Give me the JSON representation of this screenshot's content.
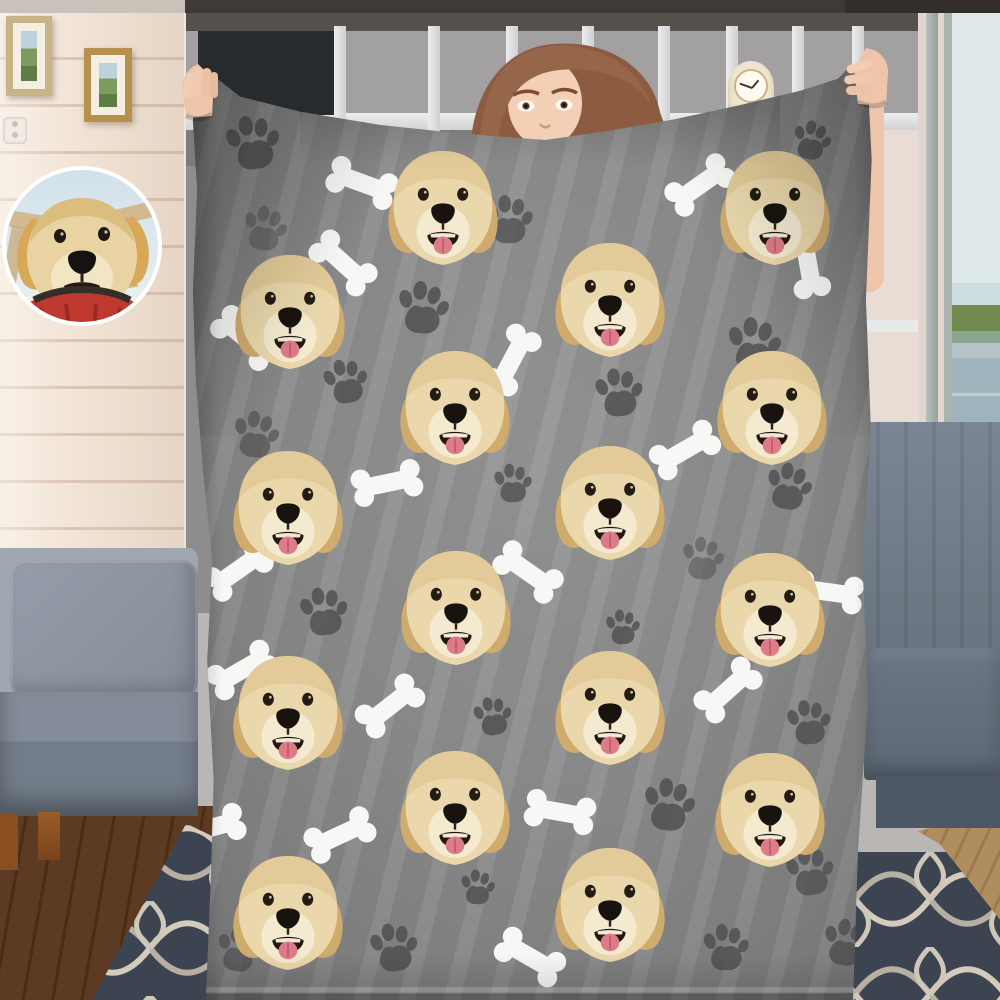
{
  "meta": {
    "type": "product-photo",
    "subject": "Person holding a custom gray fleece blanket printed with a dog's face, bones and paw prints, in a living room with bookshelves, sofas, rug and a lake-view window; circular inset photo of the dog at top left"
  },
  "palette": {
    "blanket": "#8d8d8d",
    "bone": "#f7f7f5",
    "paw": "#4e4e50",
    "fur": "#ead7ab",
    "fur_dark": "#d0ab6e",
    "muzzle": "#f3ead0",
    "mouth": "#241710",
    "tongue": "#dd7b88",
    "wall": "#f3e5d7",
    "wall_line": "#dcc6b6",
    "rug": "#3d4451",
    "rug_line": "#d3ccbd",
    "skin": "#eec5ab",
    "hair": "#8d5c40",
    "bandana": "#c0392e"
  },
  "blanket": {
    "origin": {
      "x": 180,
      "y": 56
    },
    "face_size": {
      "w": 118,
      "h": 124
    },
    "faces": [
      {
        "x": 443,
        "y": 208
      },
      {
        "x": 775,
        "y": 208
      },
      {
        "x": 290,
        "y": 312
      },
      {
        "x": 610,
        "y": 300
      },
      {
        "x": 455,
        "y": 408
      },
      {
        "x": 772,
        "y": 408
      },
      {
        "x": 288,
        "y": 508
      },
      {
        "x": 610,
        "y": 503
      },
      {
        "x": 456,
        "y": 608
      },
      {
        "x": 770,
        "y": 610
      },
      {
        "x": 288,
        "y": 713
      },
      {
        "x": 610,
        "y": 708
      },
      {
        "x": 455,
        "y": 808
      },
      {
        "x": 770,
        "y": 810
      },
      {
        "x": 288,
        "y": 913
      },
      {
        "x": 610,
        "y": 905
      }
    ],
    "bones": [
      {
        "x": 362,
        "y": 183,
        "r": 20
      },
      {
        "x": 700,
        "y": 185,
        "r": -35
      },
      {
        "x": 343,
        "y": 263,
        "r": 42
      },
      {
        "x": 808,
        "y": 263,
        "r": 80
      },
      {
        "x": 245,
        "y": 338,
        "r": 40
      },
      {
        "x": 512,
        "y": 360,
        "r": -62
      },
      {
        "x": 685,
        "y": 450,
        "r": -30
      },
      {
        "x": 387,
        "y": 483,
        "r": -12
      },
      {
        "x": 238,
        "y": 570,
        "r": -35
      },
      {
        "x": 528,
        "y": 572,
        "r": 35
      },
      {
        "x": 828,
        "y": 592,
        "r": 8
      },
      {
        "x": 242,
        "y": 670,
        "r": -30
      },
      {
        "x": 390,
        "y": 706,
        "r": -38
      },
      {
        "x": 728,
        "y": 690,
        "r": -42
      },
      {
        "x": 560,
        "y": 812,
        "r": 10
      },
      {
        "x": 340,
        "y": 835,
        "r": -25
      },
      {
        "x": 210,
        "y": 828,
        "r": -15
      },
      {
        "x": 530,
        "y": 957,
        "r": 30
      }
    ],
    "paws": [
      {
        "x": 252,
        "y": 143,
        "s": 56,
        "o": 0.8,
        "r": -8
      },
      {
        "x": 264,
        "y": 229,
        "s": 46,
        "o": 0.45,
        "r": 10
      },
      {
        "x": 508,
        "y": 220,
        "s": 50,
        "o": 0.75,
        "r": 0
      },
      {
        "x": 811,
        "y": 140,
        "s": 40,
        "o": 0.8,
        "r": 12
      },
      {
        "x": 753,
        "y": 238,
        "s": 44,
        "o": 0.4,
        "r": -6
      },
      {
        "x": 422,
        "y": 308,
        "s": 54,
        "o": 0.8,
        "r": 6
      },
      {
        "x": 345,
        "y": 382,
        "s": 46,
        "o": 0.8,
        "r": -10
      },
      {
        "x": 753,
        "y": 345,
        "s": 56,
        "o": 0.8,
        "r": 4
      },
      {
        "x": 618,
        "y": 393,
        "s": 50,
        "o": 0.8,
        "r": -4
      },
      {
        "x": 255,
        "y": 435,
        "s": 48,
        "o": 0.65,
        "r": 8
      },
      {
        "x": 512,
        "y": 483,
        "s": 40,
        "o": 0.75,
        "r": 0
      },
      {
        "x": 788,
        "y": 487,
        "s": 48,
        "o": 0.8,
        "r": 10
      },
      {
        "x": 323,
        "y": 612,
        "s": 50,
        "o": 0.8,
        "r": -6
      },
      {
        "x": 702,
        "y": 558,
        "s": 44,
        "o": 0.5,
        "r": 6
      },
      {
        "x": 622,
        "y": 627,
        "s": 36,
        "o": 0.8,
        "r": 0
      },
      {
        "x": 492,
        "y": 716,
        "s": 40,
        "o": 0.8,
        "r": -8
      },
      {
        "x": 668,
        "y": 805,
        "s": 54,
        "o": 0.8,
        "r": 6
      },
      {
        "x": 808,
        "y": 723,
        "s": 46,
        "o": 0.8,
        "r": -4
      },
      {
        "x": 477,
        "y": 887,
        "s": 36,
        "o": 0.8,
        "r": 4
      },
      {
        "x": 393,
        "y": 948,
        "s": 50,
        "o": 0.8,
        "r": -6
      },
      {
        "x": 238,
        "y": 950,
        "s": 46,
        "o": 0.7,
        "r": 8
      },
      {
        "x": 725,
        "y": 948,
        "s": 48,
        "o": 0.8,
        "r": 0
      },
      {
        "x": 845,
        "y": 943,
        "s": 48,
        "o": 0.8,
        "r": 10
      },
      {
        "x": 809,
        "y": 872,
        "s": 50,
        "o": 0.75,
        "r": -6
      }
    ]
  },
  "bookshelf": {
    "book_groups": [
      {
        "x": 24,
        "y": 35,
        "w": 58,
        "h": 66,
        "dir": "h",
        "colors": [
          "#7c382c",
          "#8a5a38",
          "#6b3226",
          "#9a6a42",
          "#7c382c",
          "#5e2f24"
        ]
      },
      {
        "x": 160,
        "y": 31,
        "w": 76,
        "h": 70,
        "dir": "v",
        "colors": [
          "#c9a66b",
          "#8a5a38",
          "#b08950",
          "#6e4a2e",
          "#c9b089",
          "#7a4a30",
          "#96714a"
        ]
      },
      {
        "x": 254,
        "y": 35,
        "w": 62,
        "h": 66,
        "dir": "v",
        "colors": [
          "#8a6a4a",
          "#6e4a2e",
          "#a08058",
          "#7a5638",
          "#5e3e28"
        ]
      },
      {
        "x": 402,
        "y": 37,
        "w": 70,
        "h": 64,
        "dir": "v",
        "colors": [
          "#a83c32",
          "#3f7d7a",
          "#e0d6b8",
          "#c89a58",
          "#8a5f38",
          "#30455e"
        ]
      },
      {
        "x": 612,
        "y": 42,
        "w": 56,
        "h": 58,
        "dir": "v",
        "colors": [
          "#c08a4a",
          "#3e7a78",
          "#d07828",
          "#8a5f38",
          "#c9a66b"
        ]
      },
      {
        "x": 682,
        "y": 45,
        "w": 48,
        "h": 55,
        "dir": "v",
        "colors": [
          "#7a5a3a",
          "#9a7a52",
          "#6b4a30",
          "#8a6a46"
        ]
      },
      {
        "x": 676,
        "y": 159,
        "w": 56,
        "h": 58,
        "dir": "h",
        "colors": [
          "#c9a878",
          "#b89058",
          "#d4b088",
          "#a8824e",
          "#c9a878",
          "#b08950"
        ]
      },
      {
        "x": 676,
        "y": 219,
        "w": 56,
        "h": 30,
        "dir": "h",
        "colors": [
          "#d07828",
          "#e08838",
          "#c06820"
        ]
      },
      {
        "x": 676,
        "y": 251,
        "w": 56,
        "h": 56,
        "dir": "h",
        "colors": [
          "#4a7a9a",
          "#3e6a88",
          "#5a8aa8",
          "#36617e",
          "#4a7a9a"
        ]
      }
    ],
    "divider_xs": [
      148,
      242,
      320,
      396,
      472,
      540,
      606,
      666,
      734
    ]
  }
}
